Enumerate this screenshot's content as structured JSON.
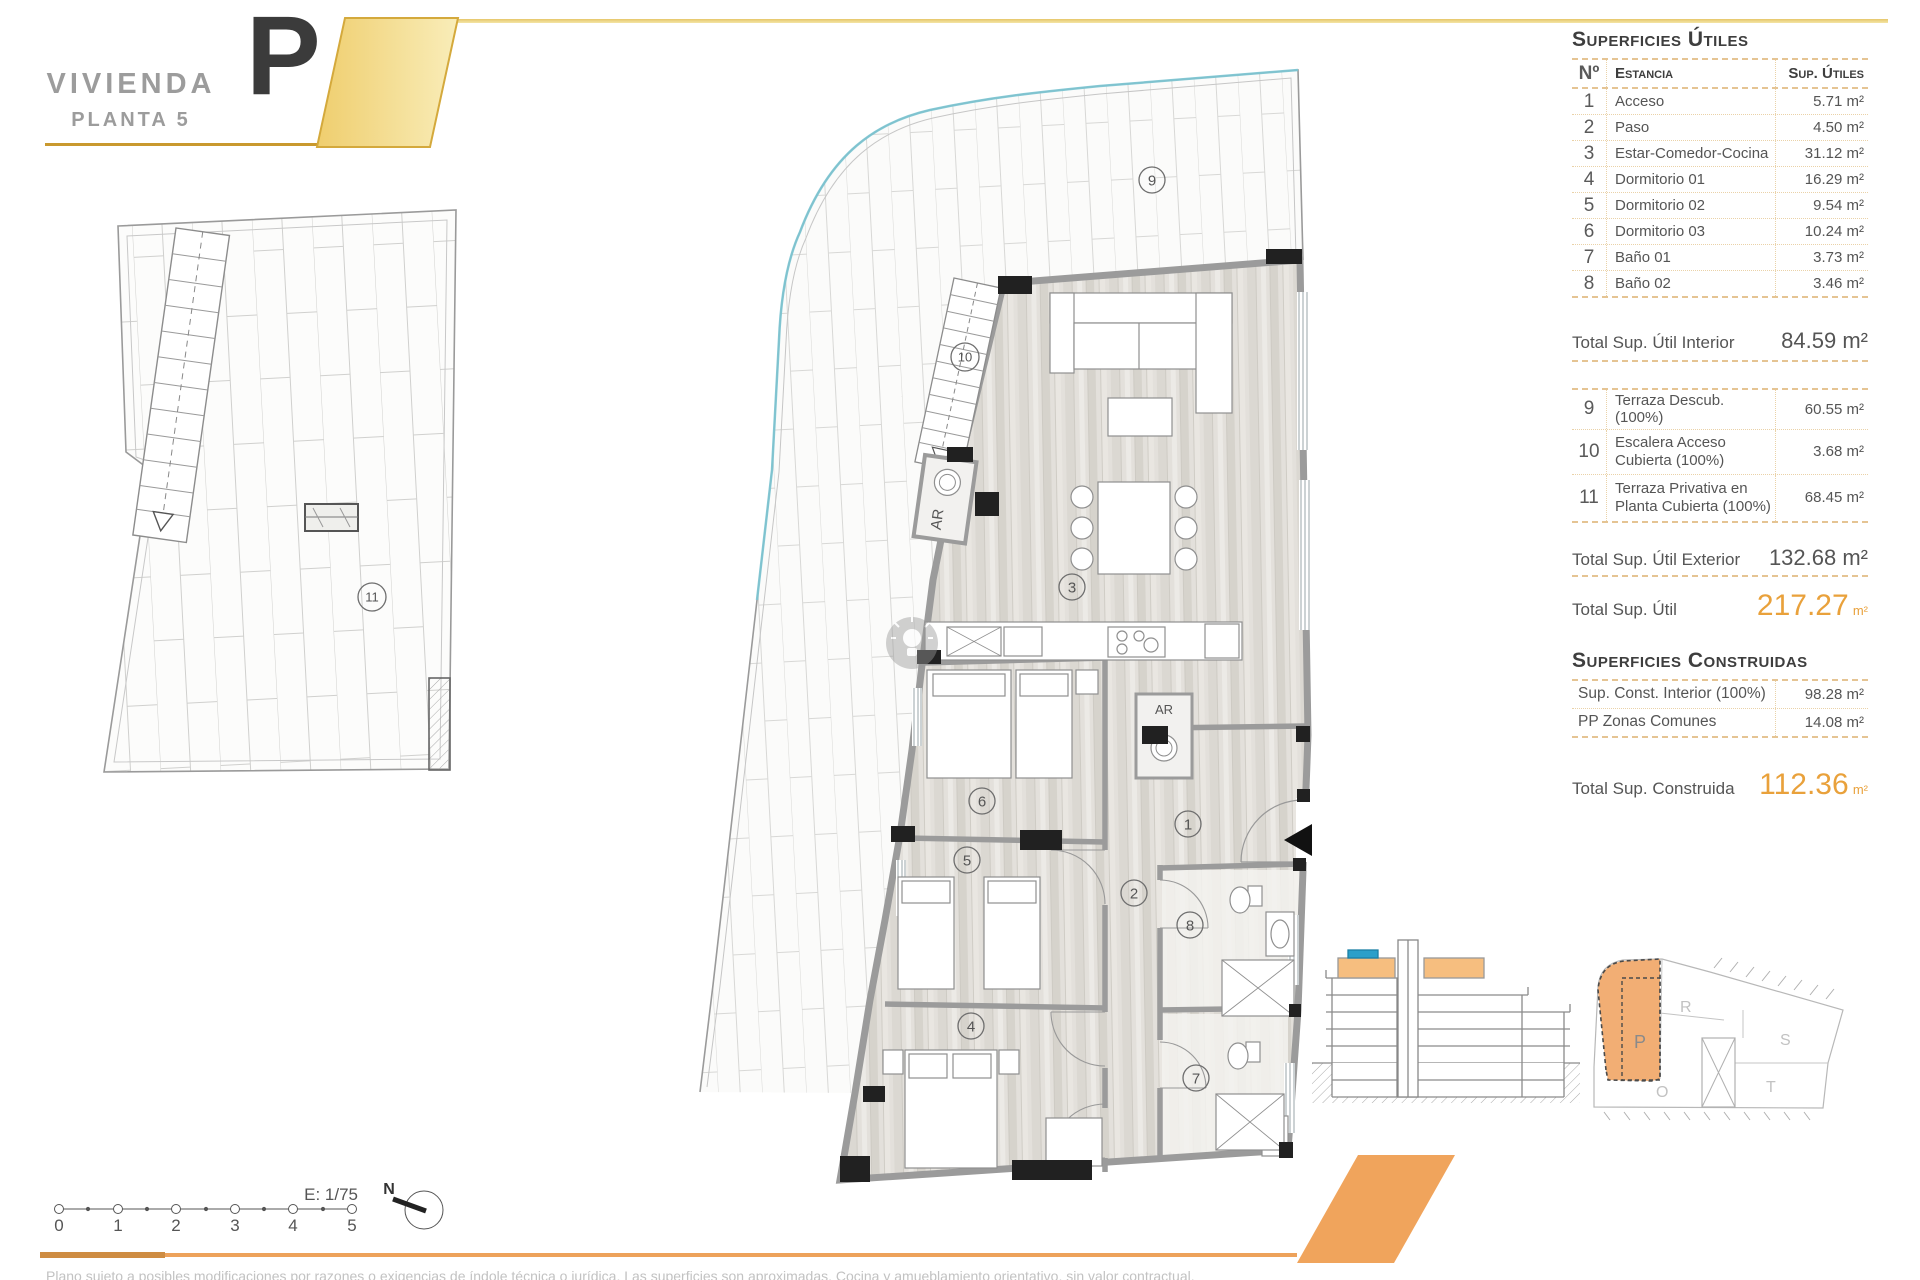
{
  "title_block": {
    "name": "VIVIENDA",
    "floor": "PLANTA 5",
    "unit": "P"
  },
  "panel": {
    "utiles": {
      "title": "Superficies Útiles",
      "col_num": "Nº",
      "col_room": "Estancia",
      "col_area": "Sup. Útiles",
      "rows": [
        {
          "num": "1",
          "room": "Acceso",
          "area": "5.71 m²"
        },
        {
          "num": "2",
          "room": "Paso",
          "area": "4.50 m²"
        },
        {
          "num": "3",
          "room": "Estar-Comedor-Cocina",
          "area": "31.12 m²"
        },
        {
          "num": "4",
          "room": "Dormitorio 01",
          "area": "16.29 m²"
        },
        {
          "num": "5",
          "room": "Dormitorio 02",
          "area": "9.54 m²"
        },
        {
          "num": "6",
          "room": "Dormitorio 03",
          "area": "10.24 m²"
        },
        {
          "num": "7",
          "room": "Baño 01",
          "area": "3.73 m²"
        },
        {
          "num": "8",
          "room": "Baño 02",
          "area": "3.46 m²"
        }
      ],
      "total_interior_label": "Total Sup. Útil Interior",
      "total_interior_value": "84.59 m²",
      "exterior_rows": [
        {
          "num": "9",
          "room": "Terraza Descub.(100%)",
          "area": "60.55 m²"
        },
        {
          "num": "10",
          "room": "Escalera Acceso Cubierta (100%)",
          "area": "3.68 m²"
        },
        {
          "num": "11",
          "room": "Terraza Privativa en Planta Cubierta (100%)",
          "area": "68.45 m²"
        }
      ],
      "total_exterior_label": "Total Sup. Útil Exterior",
      "total_exterior_value": "132.68 m²",
      "total_label": "Total Sup. Útil",
      "total_value": "217.27",
      "total_unit": "m²"
    },
    "construidas": {
      "title": "Superficies Construidas",
      "rows": [
        {
          "label": "Sup. Const. Interior (100%)",
          "value": "98.28 m²"
        },
        {
          "label": "PP Zonas Comunes",
          "value": "14.08 m²"
        }
      ],
      "total_label": "Total Sup. Construida",
      "total_value": "112.36",
      "total_unit": "m²"
    }
  },
  "plan": {
    "room_numbers": [
      "1",
      "2",
      "3",
      "4",
      "5",
      "6",
      "7",
      "8",
      "9",
      "10",
      "11"
    ],
    "ar_label": "AR",
    "scale_label": "E: 1/75",
    "north_label": "N",
    "scale_ticks": [
      "0",
      "1",
      "2",
      "3",
      "4",
      "5"
    ]
  },
  "site_key": {
    "highlighted": "P",
    "units": {
      "p": "P",
      "r": "R",
      "s": "S",
      "t": "T",
      "o": "O"
    }
  },
  "footer": {
    "disclaimer": "Plano sujeto a posibles modificaciones por razones o exigencias de índole técnica o jurídica. Las superficies son aproximadas. Cocina y amueblamiento orientativo, sin valor contractual."
  },
  "colors": {
    "accent_orange": "#E9A13B",
    "band_orange": "#EDA25B",
    "gold": "#C9992E",
    "yellow_fill": "#F5DC8C",
    "table_border_tan": "#E5C493",
    "teal_pool": "#7CC7D4",
    "section_highlight": "#F6BE7F",
    "section_pool_blue": "#2B9FC9",
    "wall_gray": "#9B9B9B"
  }
}
